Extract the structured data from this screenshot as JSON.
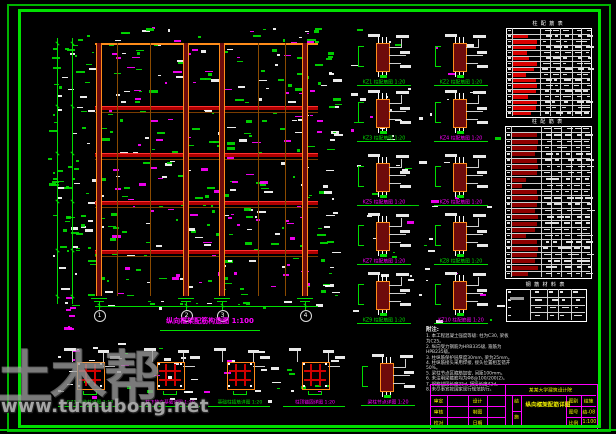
{
  "palette": {
    "green": "#00dd00",
    "magenta": "#ff00ff",
    "orange": "#ff8c1a",
    "beam": "#b00000",
    "beam_hi": "#ff3030",
    "col_fill": "#6e0b0b",
    "white": "#ffffff",
    "yellow": "#f2f200",
    "table_red_a": "#d90000",
    "table_red_b": "#8f0000"
  },
  "watermark": {
    "logo": "土木帮",
    "url": "www.tumubong.net"
  },
  "elevation": {
    "title": "纵向框架配筋构造图 1:100",
    "columns_x": [
      99,
      186,
      222,
      305
    ],
    "thin_columns_x": [
      117,
      150,
      258,
      285
    ],
    "beams_y": [
      106,
      153,
      201,
      250
    ],
    "top_y": 43,
    "base_y": 296,
    "left_x": 95,
    "right_x": 318,
    "dim_chains_x": [
      57,
      72
    ],
    "bubbles": {
      "y": 310,
      "labels": [
        "1",
        "2",
        "3",
        "4"
      ]
    }
  },
  "details": {
    "cols_x": [
      384,
      461
    ],
    "row_tops": [
      34,
      90,
      154,
      213,
      272
    ],
    "middle": [
      {
        "label": "KZ1 柱配筋图 1:20",
        "color": "green"
      },
      {
        "label": "KZ2 柱配筋图 1:20",
        "color": "green"
      },
      {
        "label": "KZ3 柱配筋图 1:20",
        "color": "green"
      },
      {
        "label": "KZ4 柱配筋图 1:20",
        "color": "magenta"
      },
      {
        "label": "KZ5 柱配筋图 1:20",
        "color": "magenta"
      },
      {
        "label": "KZ6 柱配筋图 1:20",
        "color": "magenta"
      },
      {
        "label": "KZ7 柱配筋图 1:20",
        "color": "magenta"
      },
      {
        "label": "KZ8 柱配筋图 1:20",
        "color": "green"
      },
      {
        "label": "KZ9 柱配筋图 1:20",
        "color": "green"
      },
      {
        "label": "KZ10 柱配筋图 1:20",
        "color": "magenta"
      }
    ],
    "bottom_x": [
      90,
      170,
      240,
      315,
      388
    ],
    "bottom_top": 348,
    "bottom": [
      {
        "label": "GZ1 构造柱详图 1:10",
        "color": "green",
        "variant": "section"
      },
      {
        "label": "柱下独立基础详图 1:20",
        "color": "magenta",
        "variant": "section"
      },
      {
        "label": "基础柱插筋详图 1:20",
        "color": "green",
        "variant": "section"
      },
      {
        "label": "柱顶锚固详图 1:20",
        "color": "magenta",
        "variant": "section"
      },
      {
        "label": "梁柱节点详图 1:20",
        "color": "magenta",
        "variant": "column"
      }
    ]
  },
  "tables": {
    "list": [
      {
        "id": "A",
        "title": "柱 配 筋 表",
        "x": 506,
        "y": 28,
        "w": 84,
        "h": 88,
        "rows": 16,
        "seed": 5,
        "colfr": [
          0.07,
          0.4,
          0.52,
          0.645,
          0.78,
          0.89
        ],
        "red0": 0.07,
        "red1": 0.4,
        "red": "#d90000",
        "bars": [
          0,
          0.6,
          0.95,
          0.9,
          0.55,
          0.65,
          0.95,
          0.85,
          0.5,
          0.9,
          0.95,
          0.9,
          0.6,
          0.95,
          0.9,
          0.7
        ]
      },
      {
        "id": "B",
        "title": "柱 配 筋 表",
        "x": 505,
        "y": 126,
        "w": 85,
        "h": 151,
        "rows": 24,
        "seed": 9,
        "colfr": [
          0.07,
          0.42,
          0.54,
          0.66,
          0.78,
          0.89
        ],
        "red0": 0.07,
        "red1": 0.42,
        "red": "#8f0000",
        "bars": [
          0,
          0.9,
          0.95,
          0.9,
          0.85,
          0.9,
          0.95,
          0.9,
          0.5,
          0.35,
          0.9,
          0.95,
          0.9,
          0.85,
          0.95,
          0.9,
          0.85,
          0.5,
          0.9,
          0.95,
          0.9,
          0.85,
          0.95,
          0.6
        ]
      },
      {
        "id": "C",
        "title": "钢 筋 材 料 表",
        "x": 506,
        "y": 289,
        "w": 79,
        "h": 31,
        "rows": 4,
        "seed": 13,
        "colfr": [
          0.3,
          0.52,
          0.66,
          0.82
        ],
        "bigleft": true
      }
    ]
  },
  "notes": {
    "title": "附注:",
    "lines": [
      "1. 本工程混凝土强度等级: 柱为C30, 梁板为C25。",
      "2. 纵向受力钢筋为HRB335级, 箍筋为HPB235级。",
      "3. 柱纵筋保护层厚度30mm, 梁为25mm。",
      "4. 柱纵筋接头采用焊接, 接头位置相互错开50%。",
      "5. 梁柱节点区箍筋加密, 间距100mm。",
      "6. 未注明梁箍筋均为Φ8@100/200(2)。",
      "7. 钢筋锚固长度35d, 搭接长度42d。",
      "8. 未尽事宜按国家现行规范执行。"
    ]
  },
  "titleblock": {
    "project": "某某大学建筑设计院",
    "left_labels_1": [
      "审定",
      "审核",
      "校对"
    ],
    "left_labels_2": [
      "设计",
      "制图",
      "日期"
    ],
    "type_chars": [
      "结",
      "施"
    ],
    "main_title": "纵向框架配筋详图",
    "info": [
      [
        "图别",
        "结施"
      ],
      [
        "图号",
        "结-08"
      ],
      [
        "比例",
        "1:100"
      ]
    ]
  },
  "decor": [
    {
      "x": 95,
      "y": 27,
      "w": 224,
      "h": 268,
      "count": 300,
      "seed": 11,
      "colors": [
        "#00dd00",
        "#00dd00",
        "#ffffff",
        "#ff00ff",
        "#00dd00",
        "#ffffff",
        "#ff00ff"
      ]
    },
    {
      "x": 48,
      "y": 34,
      "w": 44,
      "h": 272,
      "count": 80,
      "seed": 22,
      "colors": [
        "#00dd00",
        "#ffffff",
        "#00dd00"
      ]
    },
    {
      "x": 320,
      "y": 40,
      "w": 16,
      "h": 255,
      "count": 36,
      "seed": 33,
      "colors": [
        "#00dd00",
        "#ffffff"
      ]
    },
    {
      "x": 64,
      "y": 294,
      "w": 12,
      "h": 34,
      "count": 7,
      "seed": 44,
      "colors": [
        "#ff00ff"
      ]
    },
    {
      "x": 95,
      "y": 300,
      "w": 222,
      "h": 9,
      "count": 16,
      "seed": 55,
      "colors": [
        "#ffffff",
        "#00dd00"
      ]
    },
    {
      "x": 350,
      "y": 28,
      "w": 148,
      "h": 292,
      "count": 60,
      "seed": 66,
      "colors": [
        "#ffffff",
        "#ffffff",
        "#ff00ff",
        "#00dd00"
      ]
    },
    {
      "x": 55,
      "y": 342,
      "w": 290,
      "h": 60,
      "count": 50,
      "seed": 77,
      "colors": [
        "#ffffff",
        "#ffffff",
        "#00dd00",
        "#ff00ff"
      ]
    }
  ]
}
